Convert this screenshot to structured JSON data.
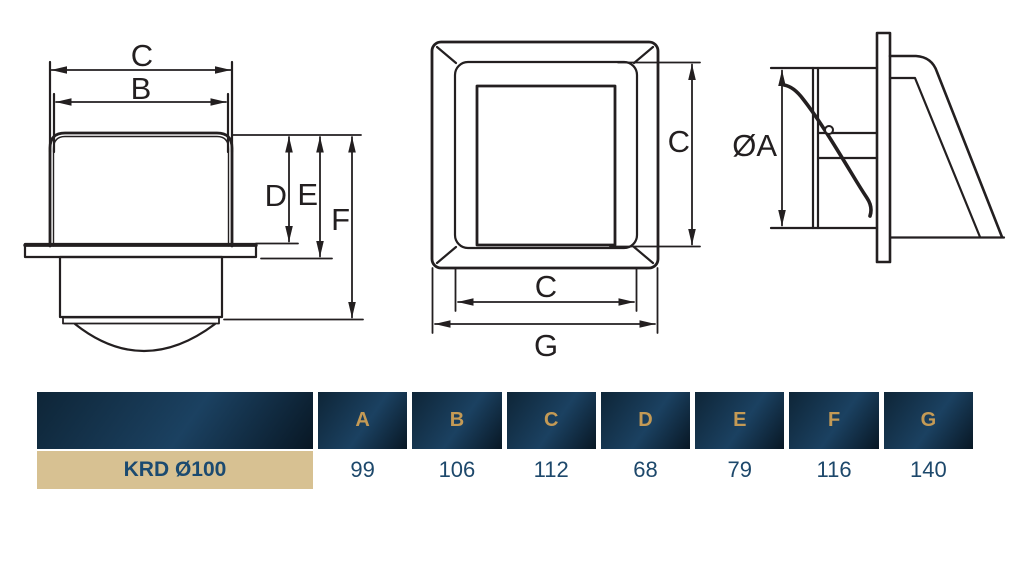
{
  "drawing": {
    "front": {
      "width_outer": "C",
      "width_inner": "B",
      "height_body": "D",
      "height_flange": "E",
      "height_total": "F"
    },
    "face": {
      "height": "C",
      "width": "C",
      "total_width": "G"
    },
    "side": {
      "diameter": "ØA"
    }
  },
  "table": {
    "row_label": "KRD Ø100",
    "columns": [
      "A",
      "B",
      "C",
      "D",
      "E",
      "F",
      "G"
    ],
    "values": [
      99,
      106,
      112,
      68,
      79,
      116,
      140
    ]
  },
  "theme": {
    "line_color": "#231f20",
    "header_bg_start": "#0e2537",
    "header_bg_mid": "#1b4161",
    "header_bg_end": "#081724",
    "header_text": "#c49a55",
    "row_label_bg": "#d7c192",
    "row_label_text": "#1b4a70",
    "value_text": "#1d486b"
  }
}
